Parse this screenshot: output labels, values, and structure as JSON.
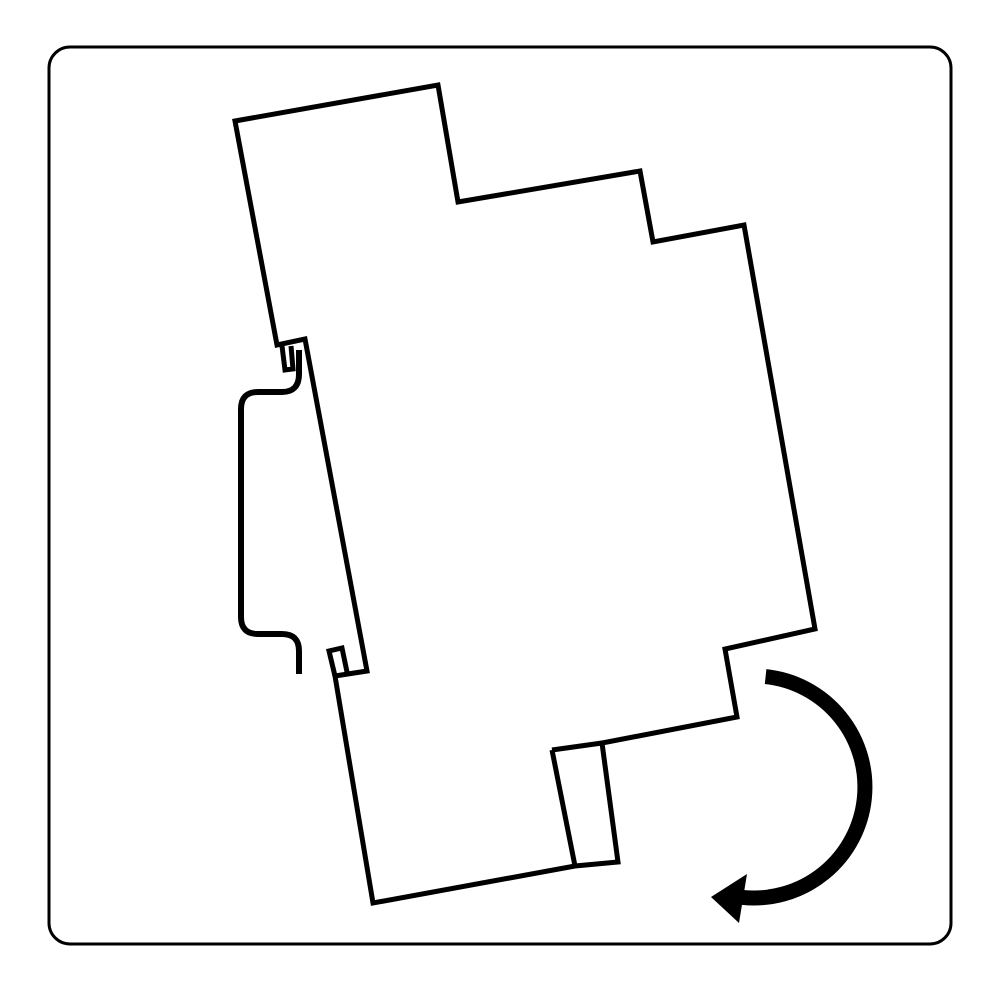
{
  "canvas": {
    "width": 1000,
    "height": 1000,
    "background": "#ffffff"
  },
  "colors": {
    "ink": "#000000",
    "background": "#ffffff"
  },
  "strokes": {
    "frame": 3,
    "device": 5,
    "rail": 6,
    "arrow": 15
  },
  "frame": {
    "x": 49,
    "y": 47,
    "width": 902,
    "height": 897,
    "corner_radius": 21
  },
  "shapes": {
    "device_outline": "M 235 121 L 438 85 L 458 202 L 640 171 L 653 242 L 744 225 L 815 629 L 725 649 L 737 717 L 602 743 L 618 862 L 575 866 L 373 903 L 335 676 L 367 671 L 305 339 L 277 345 Z",
    "latch_foot_lines": "M 552 750 L 602 743 M 552 750 L 575 866",
    "bottom_claw": "M 335 676 L 329 651 L 342 648 L 347 672",
    "top_claw_groove": "M 282 346 L 285 370 L 293 369 L 291 346",
    "din_rail_profile": "M 299 350 L 299 374 Q 299 392 282 392 L 258 392 Q 241 392 241 409 L 241 617 Q 241 634 258 634 L 282 634 Q 299 634 299 651 L 299 674",
    "rotation_arrow_arc": "M 765.6 676.6 A 111 111 0 0 1 742.4 897.4",
    "rotation_arrow_head": "M 711 897 L 747 874 L 739 923 Z"
  }
}
